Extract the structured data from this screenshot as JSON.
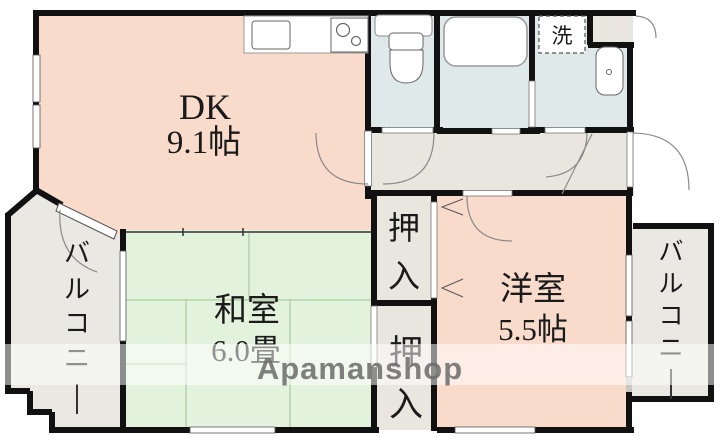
{
  "floorplan": {
    "title": "apartment-floorplan",
    "watermark": {
      "text": "Apamanshop"
    },
    "rooms": {
      "dk": {
        "label": "DK",
        "size": "9.1帖"
      },
      "washitsu": {
        "label": "和室",
        "size": "6.0畳"
      },
      "youshitsu": {
        "label": "洋室",
        "size": "5.5帖"
      },
      "closet_upper": {
        "label": "押入"
      },
      "closet_lower": {
        "label": "押入"
      },
      "balcony_left": {
        "label": "バルコニー"
      },
      "balcony_right": {
        "label": "バルコニー"
      },
      "laundry": {
        "label": "洗"
      }
    },
    "fixtures": [
      "kitchen-sink",
      "stove-two-burners",
      "toilet",
      "bathtub",
      "washing-machine-space",
      "washbasin"
    ],
    "colors": {
      "room_pink": "#f9dbcc",
      "tatami_green": "#e3f2dc",
      "wet_area_blue": "#dfe9e9",
      "hall_beige": "#e8e6de",
      "balcony_grey": "#e9e8e2",
      "wall_black": "#111111",
      "tatami_line": "#a9cba1",
      "watermark_grey": "#6b6b6b"
    }
  }
}
